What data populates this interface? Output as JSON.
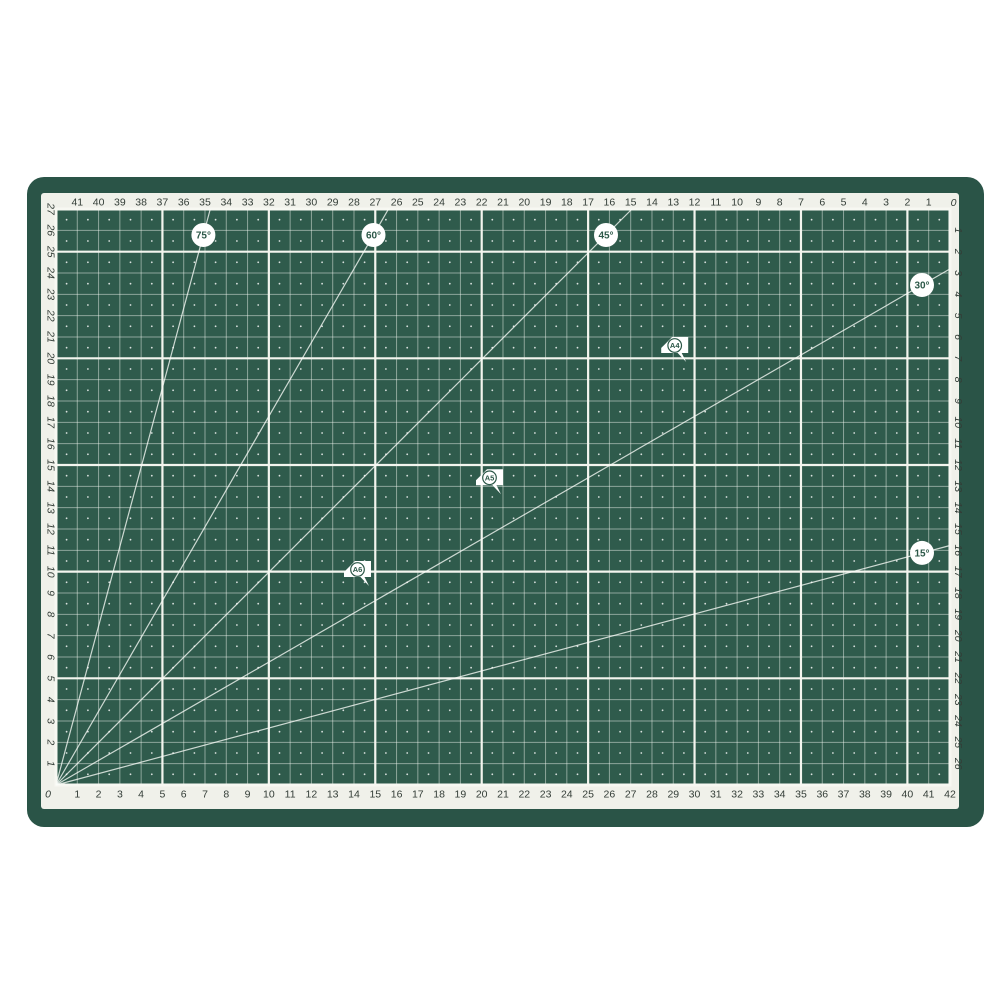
{
  "mat": {
    "grid": {
      "columns": 42,
      "rows": 27,
      "major_every": 5
    },
    "rulers": {
      "top": {
        "numbers": [
          41,
          40,
          39,
          38,
          37,
          36,
          35,
          34,
          33,
          32,
          31,
          30,
          29,
          28,
          27,
          26,
          25,
          24,
          23,
          22,
          21,
          20,
          19,
          18,
          17,
          16,
          15,
          14,
          13,
          12,
          11,
          10,
          9,
          8,
          7,
          6,
          5,
          4,
          3,
          2,
          1
        ],
        "corner_label": "0"
      },
      "bottom": {
        "numbers": [
          1,
          2,
          3,
          4,
          5,
          6,
          7,
          8,
          9,
          10,
          11,
          12,
          13,
          14,
          15,
          16,
          17,
          18,
          19,
          20,
          21,
          22,
          23,
          24,
          25,
          26,
          27,
          28,
          29,
          30,
          31,
          32,
          33,
          34,
          35,
          36,
          37,
          38,
          39,
          40,
          41,
          42
        ],
        "corner_label": "0"
      },
      "left": {
        "numbers": [
          27,
          26,
          25,
          24,
          23,
          22,
          21,
          20,
          19,
          18,
          17,
          16,
          15,
          14,
          13,
          12,
          11,
          10,
          9,
          8,
          7,
          6,
          5,
          4,
          3,
          2,
          1
        ]
      },
      "right": {
        "numbers": [
          1,
          2,
          3,
          4,
          5,
          6,
          7,
          8,
          9,
          10,
          11,
          12,
          13,
          14,
          15,
          16,
          17,
          18,
          19,
          20,
          21,
          22,
          23,
          24,
          25,
          26
        ]
      }
    },
    "angle_lines": [
      {
        "label": "75°",
        "degrees": 75
      },
      {
        "label": "60°",
        "degrees": 60
      },
      {
        "label": "45°",
        "degrees": 45
      },
      {
        "label": "30°",
        "degrees": 30
      },
      {
        "label": "15°",
        "degrees": 15
      }
    ],
    "paper_markers": [
      {
        "label": "A4",
        "width_cm": 29.7,
        "height_cm": 21.0
      },
      {
        "label": "A5",
        "width_cm": 21.0,
        "height_cm": 14.8
      },
      {
        "label": "A6",
        "width_cm": 14.8,
        "height_cm": 10.5
      }
    ],
    "colors": {
      "page_bg": "#ffffff",
      "rim": "#2a5447",
      "surface": "#2f5b4c",
      "band": "#f0f1ea",
      "grid_minor": "rgba(244,249,243,0.48)",
      "grid_major": "#f3f5ee",
      "grid_border": "#f7f8f2",
      "dot": "rgba(255,255,255,0.82)",
      "number_text": "#333d37",
      "angle_line": "rgba(250,252,248,0.78)",
      "label_circle_fill": "#ffffff",
      "label_text": "#2c5848"
    }
  }
}
